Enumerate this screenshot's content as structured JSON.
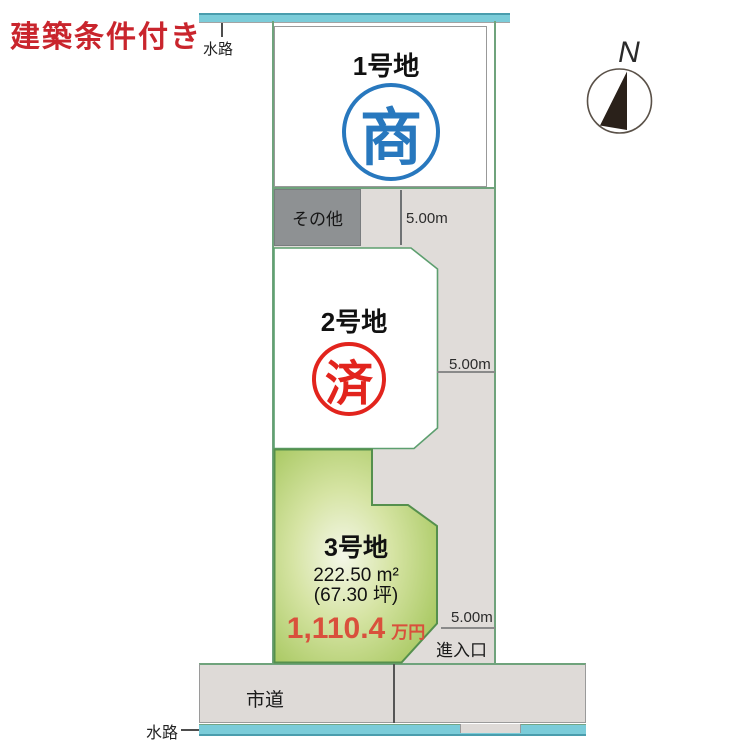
{
  "note": {
    "label": "建築条件付き",
    "color": "#c9252d"
  },
  "compass": {
    "label": "N"
  },
  "waterways": {
    "top_label": "水路",
    "bottom_label": "水路"
  },
  "road": {
    "label": "市道"
  },
  "entrance": {
    "label": "進入口"
  },
  "other_area": {
    "label": "その他"
  },
  "measurements": {
    "top": "5.00m",
    "middle": "5.00m",
    "bottom": "5.00m"
  },
  "lots": {
    "lot1": {
      "name": "1号地",
      "stamp": "商",
      "stamp_color": "#2878be"
    },
    "lot2": {
      "name": "2号地",
      "stamp": "済",
      "stamp_color": "#e2241d"
    },
    "lot3": {
      "name": "3号地",
      "area_m2": "222.50 m²",
      "area_tsubo": "(67.30 坪)",
      "price_value": "1,110.4",
      "price_unit": "万円",
      "price_color": "#d9503c",
      "fill_color": "#a6c75e"
    }
  },
  "colors": {
    "water_cyan": "#7bccd9",
    "boundary_green": "#6fa37c",
    "driveway_gray": "#e0dcd9",
    "other_gray": "#8e9193"
  }
}
